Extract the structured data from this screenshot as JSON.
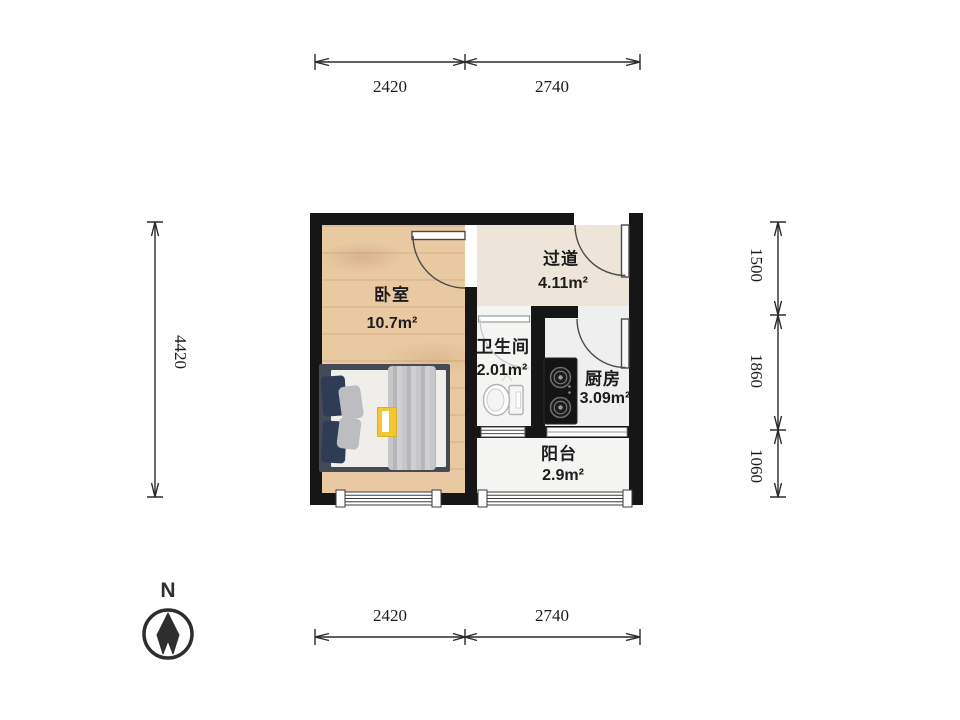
{
  "rooms": [
    {
      "name": "卧室",
      "area": "10.7m²"
    },
    {
      "name": "过道",
      "area": "4.11m²"
    },
    {
      "name": "卫生间",
      "area": "2.01m²"
    },
    {
      "name": "厨房",
      "area": "3.09m²"
    },
    {
      "name": "阳台",
      "area": "2.9m²"
    }
  ],
  "dimensions": {
    "top": [
      "2420",
      "2740"
    ],
    "bottom": [
      "2420",
      "2740"
    ],
    "left": [
      "4420"
    ],
    "right": [
      "1500",
      "1860",
      "1060"
    ]
  },
  "compass": {
    "north_label": "N"
  },
  "colors": {
    "wall": "#161616",
    "wood_floor": "#e9c9a2",
    "accent_book": "#f2c832"
  }
}
